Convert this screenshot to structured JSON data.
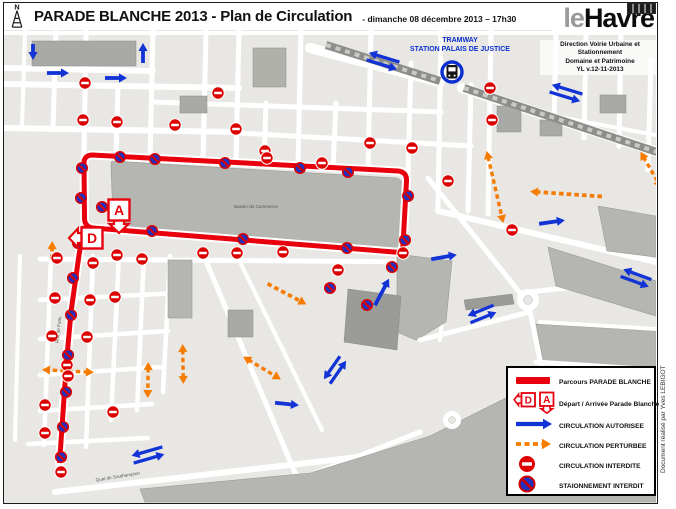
{
  "header": {
    "north_label": "N",
    "title": "PARADE BLANCHE  2013 - Plan de Circulation",
    "subtitle": "- dimanche 08 décembre 2013 – 17h30"
  },
  "logo": {
    "prefix": "le",
    "name": "Havre",
    "org_lines": [
      "Direction Voirie Urbaine et Stationnement",
      "Domaine et Patrimoine",
      "YL v.12-11-2013"
    ]
  },
  "tramway": {
    "line1": "TRAMWAY",
    "line2": "STATION PALAIS DE JUSTICE"
  },
  "map_labels": {
    "basin": "Bassin du Commerce",
    "quai": "Quai de Southampton",
    "rue": "Rue de Paris"
  },
  "markers": {
    "depart": "D",
    "arrivee": "A"
  },
  "legend": {
    "items": [
      "Parcours  PARADE BLANCHE",
      "Départ / Arrivée Parade Blanche",
      "CIRCULATION AUTORISEE",
      "CIRCULATION PERTURBEE",
      "CIRCULATION INTERDITE",
      "STAIONNEMENT INTERDIT"
    ]
  },
  "credit": "Document réalisé par Yves LEBIGOT",
  "colors": {
    "route": "#e8000d",
    "authorized": "#1233d6",
    "disturbed": "#f67c00",
    "forbidden": "#dd0000",
    "noparking": "#2030c0",
    "tram": "#0a2fd0"
  },
  "route": {
    "loop": "M 92,155 L 398,171 Q 407,172 406.5,181 L 403,245 Q 402.5,253 394,252 L 93,228 Q 85,227 84.5,219 L 84,163 Q 84,155.5 92,155 Z",
    "south": "M 84,226 L 79,255 L 71,312 L 66.5,362 L 62.5,420 L 59.5,463"
  },
  "icons": {
    "no_entry": [
      [
        85,
        83
      ],
      [
        83,
        120
      ],
      [
        117,
        122
      ],
      [
        175,
        125
      ],
      [
        218,
        93
      ],
      [
        236,
        129
      ],
      [
        265,
        151
      ],
      [
        267,
        158
      ],
      [
        322,
        163
      ],
      [
        370,
        143
      ],
      [
        412,
        148
      ],
      [
        490,
        88
      ],
      [
        492,
        120
      ],
      [
        448,
        181
      ],
      [
        512,
        230
      ],
      [
        203,
        253
      ],
      [
        237,
        253
      ],
      [
        283,
        252
      ],
      [
        338,
        270
      ],
      [
        403,
        253
      ],
      [
        57,
        258
      ],
      [
        93,
        263
      ],
      [
        117,
        255
      ],
      [
        142,
        259
      ],
      [
        55,
        298
      ],
      [
        90,
        300
      ],
      [
        115,
        297
      ],
      [
        52,
        336
      ],
      [
        87,
        337
      ],
      [
        67,
        365
      ],
      [
        68,
        376
      ],
      [
        45,
        405
      ],
      [
        113,
        412
      ],
      [
        45,
        433
      ],
      [
        61,
        472
      ]
    ],
    "no_parking": [
      [
        120,
        157
      ],
      [
        155,
        159
      ],
      [
        225,
        163
      ],
      [
        300,
        168
      ],
      [
        348,
        172
      ],
      [
        408,
        196
      ],
      [
        405,
        240
      ],
      [
        152,
        231
      ],
      [
        243,
        239
      ],
      [
        347,
        248
      ],
      [
        82,
        168
      ],
      [
        81,
        198
      ],
      [
        102,
        207
      ],
      [
        78,
        243
      ],
      [
        73,
        278
      ],
      [
        71,
        315
      ],
      [
        68,
        355
      ],
      [
        66,
        392
      ],
      [
        63,
        427
      ],
      [
        61,
        457
      ],
      [
        392,
        267
      ],
      [
        367,
        305
      ],
      [
        330,
        288
      ]
    ],
    "blue_arrows": [
      [
        33,
        52,
        16,
        90,
        "s"
      ],
      [
        58,
        73,
        22,
        0,
        "s"
      ],
      [
        116,
        78,
        22,
        0,
        "s"
      ],
      [
        143,
        53,
        20,
        -90,
        "s"
      ],
      [
        383,
        61,
        32,
        17,
        "p"
      ],
      [
        566,
        93,
        32,
        17,
        "p"
      ],
      [
        444,
        257,
        26,
        -10,
        "s"
      ],
      [
        552,
        222,
        26,
        -8,
        "s"
      ],
      [
        636,
        278,
        30,
        20,
        "p"
      ],
      [
        482,
        314,
        28,
        -22,
        "p"
      ],
      [
        382,
        292,
        30,
        -62,
        "s"
      ],
      [
        335,
        370,
        28,
        -55,
        "p"
      ],
      [
        287,
        404,
        24,
        6,
        "s"
      ],
      [
        148,
        455,
        32,
        -16,
        "p"
      ]
    ],
    "orange_arrows": [
      [
        566,
        194,
        72,
        184,
        "s"
      ],
      [
        495,
        187,
        74,
        77,
        "d"
      ],
      [
        52,
        250,
        18,
        -88,
        "s"
      ],
      [
        68,
        371,
        52,
        183,
        "d"
      ],
      [
        148,
        380,
        36,
        91,
        "d"
      ],
      [
        287,
        294,
        44,
        28,
        "s"
      ],
      [
        262,
        368,
        44,
        31,
        "d"
      ],
      [
        183,
        364,
        40,
        89,
        "d"
      ],
      [
        651,
        170,
        42,
        60,
        "d"
      ]
    ]
  }
}
